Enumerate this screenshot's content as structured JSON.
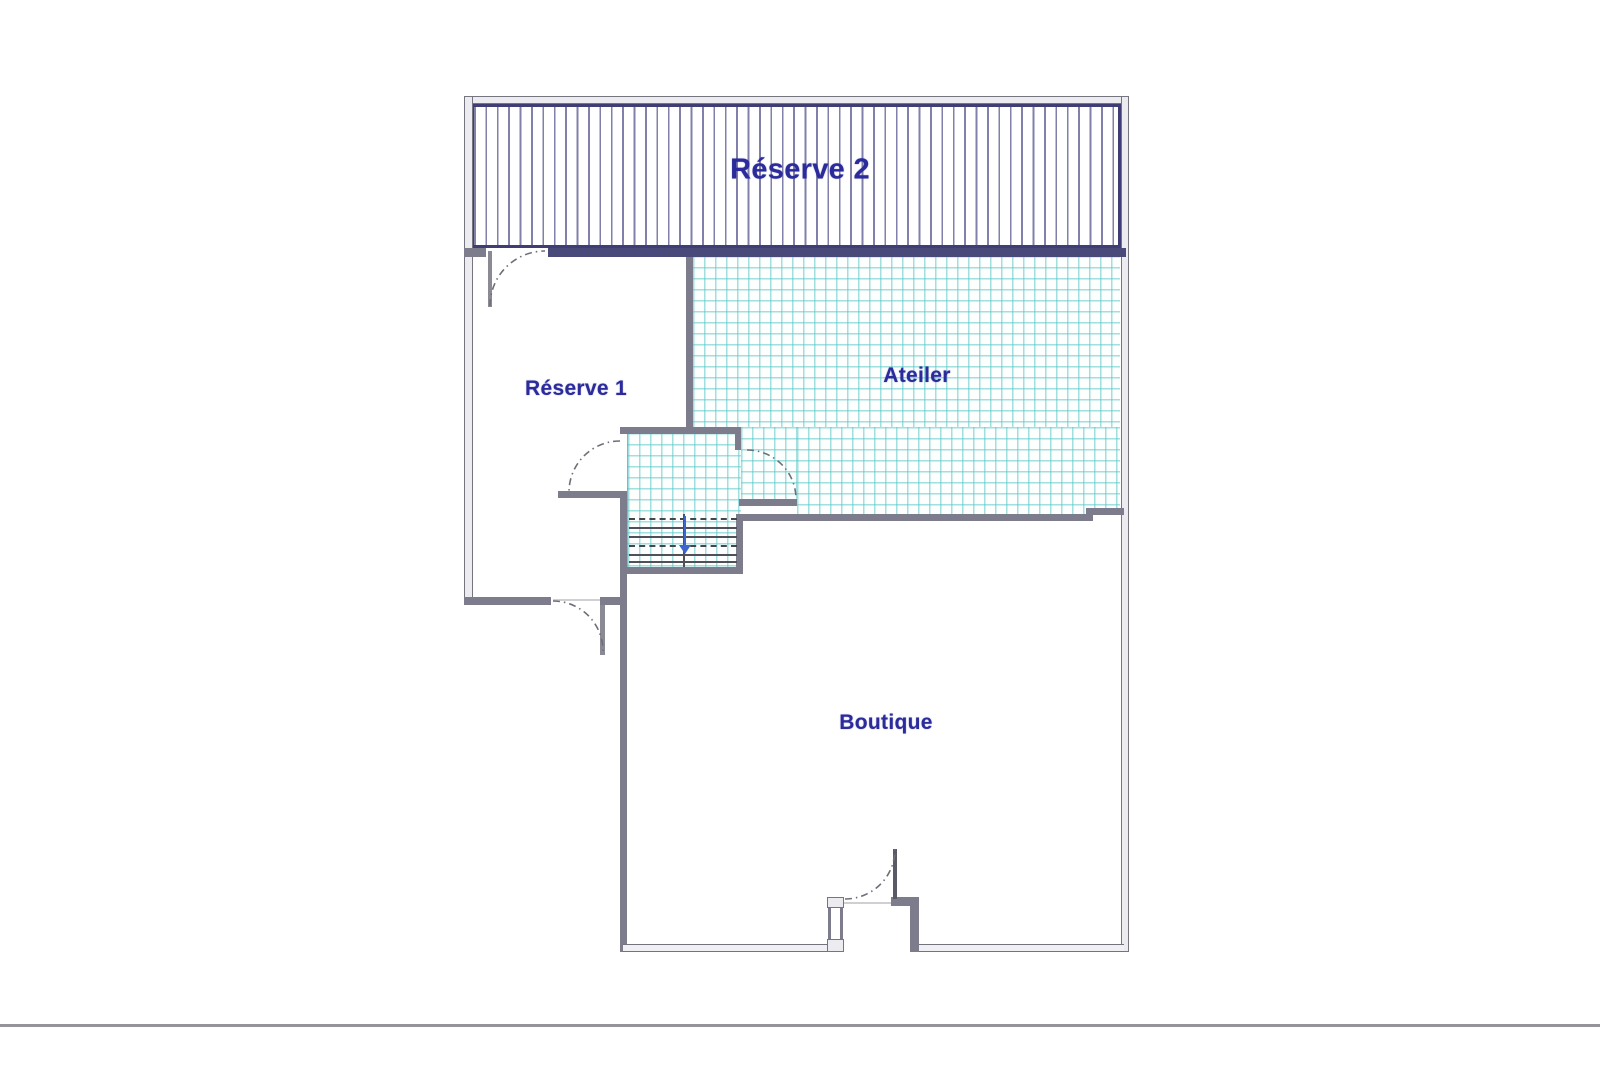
{
  "floorplan": {
    "rooms": [
      {
        "name": "reserve-2",
        "label": "Réserve 2",
        "fill": "vertical-line-hatch"
      },
      {
        "name": "reserve-1",
        "label": "Réserve 1",
        "fill": "none"
      },
      {
        "name": "atelier",
        "label": "Ateiler",
        "fill": "teal-grid-hatch"
      },
      {
        "name": "boutique",
        "label": "Boutique",
        "fill": "none"
      }
    ],
    "colors": {
      "room_label": "#2b2b9c",
      "wall_gray": "#7c7c8c",
      "wall_navy": "#4a4a7a",
      "hatch_navy": "#606096",
      "teal_grid": "#58c6c6",
      "stairs_arrow_blue": "#3f63cf"
    },
    "stairs": {
      "arrow_direction": "down"
    }
  }
}
